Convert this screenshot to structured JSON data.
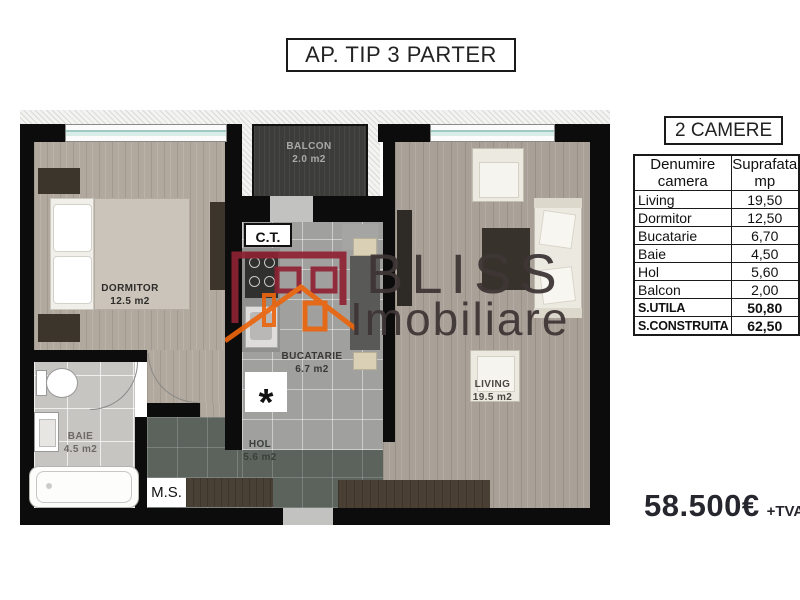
{
  "title": "AP. TIP 3 PARTER",
  "header": {
    "camere": "2 CAMERE"
  },
  "table": {
    "headers": {
      "col1a": "Denumire",
      "col1b": "camera",
      "col2a": "Suprafata",
      "col2b": "mp"
    },
    "rows": [
      {
        "name": "Living",
        "value": "19,50"
      },
      {
        "name": "Dormitor",
        "value": "12,50"
      },
      {
        "name": "Bucatarie",
        "value": "6,70"
      },
      {
        "name": "Baie",
        "value": "4,50"
      },
      {
        "name": "Hol",
        "value": "5,60"
      },
      {
        "name": "Balcon",
        "value": "2,00"
      },
      {
        "name": "S.UTILA",
        "value": "50,80"
      },
      {
        "name": "S.CONSTRUITA",
        "value": "62,50"
      }
    ]
  },
  "price": {
    "amount": "58.500€",
    "vat": "+TVA"
  },
  "plan": {
    "rooms": {
      "dormitor": {
        "name": "DORMITOR",
        "area": "12.5 m2"
      },
      "balcon": {
        "name": "BALCON",
        "area": "2.0 m2"
      },
      "bucatarie": {
        "name": "BUCATARIE",
        "area": "6.7 m2"
      },
      "living": {
        "name": "LIVING",
        "area": "19.5 m2"
      },
      "baie": {
        "name": "BAIE",
        "area": "4.5 m2"
      },
      "hol": {
        "name": "HOL",
        "area": "5.6 m2"
      }
    },
    "ct": "C.T.",
    "ms": "M.S.",
    "washer": "*"
  },
  "watermark": {
    "line1": "BLISS",
    "line2": "Imobiliare"
  },
  "colors": {
    "wall": "#0c0c0c",
    "logo_red": "#8e2233",
    "logo_orange": "#ea650d",
    "window_glass": "#9fc9c2"
  }
}
